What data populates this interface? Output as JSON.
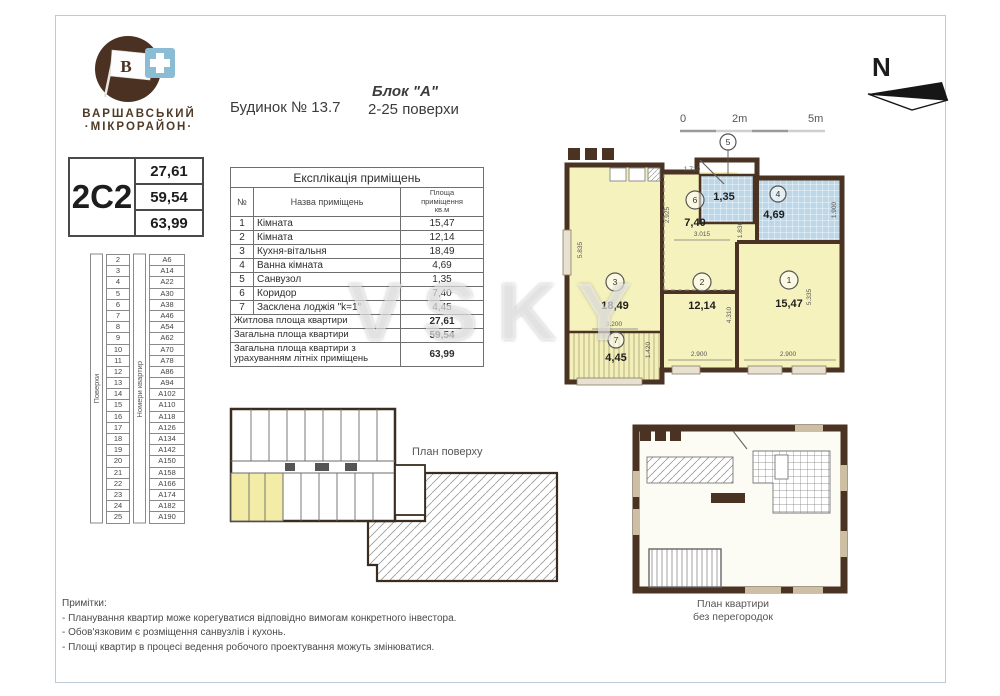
{
  "logo": {
    "line1": "ВАРШАВСЬКИЙ",
    "line2": "·МІКРОРАЙОН·",
    "flag_letter": "В"
  },
  "header": {
    "building": "Будинок № 13.7",
    "block": "Блок \"А\"",
    "floors_range": "2-25 поверхи"
  },
  "compass": {
    "north": "N"
  },
  "scale_bar": {
    "l0": "0",
    "l2": "2m",
    "l5": "5m"
  },
  "apartment_card": {
    "code": "2С2",
    "living_area": "27,61",
    "total_area": "59,54",
    "total_with_summer": "63,99"
  },
  "explication": {
    "title": "Експлікація приміщень",
    "columns": {
      "num": "№",
      "name": "Назва приміщень",
      "area1": "Площа",
      "area2": "приміщення",
      "area3": "кв.м"
    },
    "rows": [
      {
        "num": "1",
        "name": "Кімната",
        "area": "15,47"
      },
      {
        "num": "2",
        "name": "Кімната",
        "area": "12,14"
      },
      {
        "num": "3",
        "name": "Кухня-вітальня",
        "area": "18,49"
      },
      {
        "num": "4",
        "name": "Ванна кімната",
        "area": "4,69"
      },
      {
        "num": "5",
        "name": "Санвузол",
        "area": "1,35"
      },
      {
        "num": "6",
        "name": "Коридор",
        "area": "7,40"
      },
      {
        "num": "7",
        "name": "Засклена лоджія \"k=1\"",
        "area": "4,45"
      }
    ],
    "summary": [
      {
        "name": "Житлова площа квартири",
        "area": "27,61"
      },
      {
        "name": "Загальна площа квартири",
        "area": "59,54"
      },
      {
        "name": "Загальна площа квартири з урахуванням літніх приміщень",
        "area": "63,99"
      }
    ]
  },
  "floors_table": {
    "floors_label": "Поверхи",
    "apts_label": "Номери квартир",
    "rows": [
      {
        "f": "2",
        "a": "А6"
      },
      {
        "f": "3",
        "a": "А14"
      },
      {
        "f": "4",
        "a": "А22"
      },
      {
        "f": "5",
        "a": "А30"
      },
      {
        "f": "6",
        "a": "А38"
      },
      {
        "f": "7",
        "a": "А46"
      },
      {
        "f": "8",
        "a": "А54"
      },
      {
        "f": "9",
        "a": "А62"
      },
      {
        "f": "10",
        "a": "А70"
      },
      {
        "f": "11",
        "a": "А78"
      },
      {
        "f": "12",
        "a": "А86"
      },
      {
        "f": "13",
        "a": "А94"
      },
      {
        "f": "14",
        "a": "А102"
      },
      {
        "f": "15",
        "a": "А110"
      },
      {
        "f": "16",
        "a": "А118"
      },
      {
        "f": "17",
        "a": "А126"
      },
      {
        "f": "18",
        "a": "А134"
      },
      {
        "f": "19",
        "a": "А142"
      },
      {
        "f": "20",
        "a": "А150"
      },
      {
        "f": "21",
        "a": "А158"
      },
      {
        "f": "22",
        "a": "А166"
      },
      {
        "f": "23",
        "a": "А174"
      },
      {
        "f": "24",
        "a": "А182"
      },
      {
        "f": "25",
        "a": "А190"
      }
    ]
  },
  "plan": {
    "rooms": {
      "r1": {
        "num": "1",
        "area": "15,47"
      },
      "r2": {
        "num": "2",
        "area": "12,14"
      },
      "r3": {
        "num": "3",
        "area": "18,49"
      },
      "r4": {
        "num": "4",
        "area": "4,69"
      },
      "r5": {
        "num": "5",
        "area": "1,35"
      },
      "r6": {
        "num": "6",
        "area": "7,40"
      },
      "r7": {
        "num": "7",
        "area": "4,45"
      }
    },
    "dims": {
      "left_h": "5.835",
      "k_width": "3.200",
      "corr_left": "2.925",
      "corr_top": "1.710",
      "corr_bottom": "3.015",
      "corr_right": "1.836",
      "bath_right": "1.900",
      "mid_v": "4.310",
      "right_h": "5.335",
      "w2": "2.900",
      "w1": "2.900",
      "loggia_r": "1.420"
    }
  },
  "floor_plan_label": "План поверху",
  "unit_plan_label": {
    "line1": "План квартири",
    "line2": "без перегородок"
  },
  "notes": {
    "title": "Примітки:",
    "items": [
      "- Планування квартир може корегуватися відповідно вимогам конкретного інвестора.",
      "- Обов'язковим є розміщення санвузлів і кухонь.",
      "- Площі квартир в процесі ведення  робочого проектування  можуть змінюватися."
    ]
  },
  "watermark": "VSKY"
}
